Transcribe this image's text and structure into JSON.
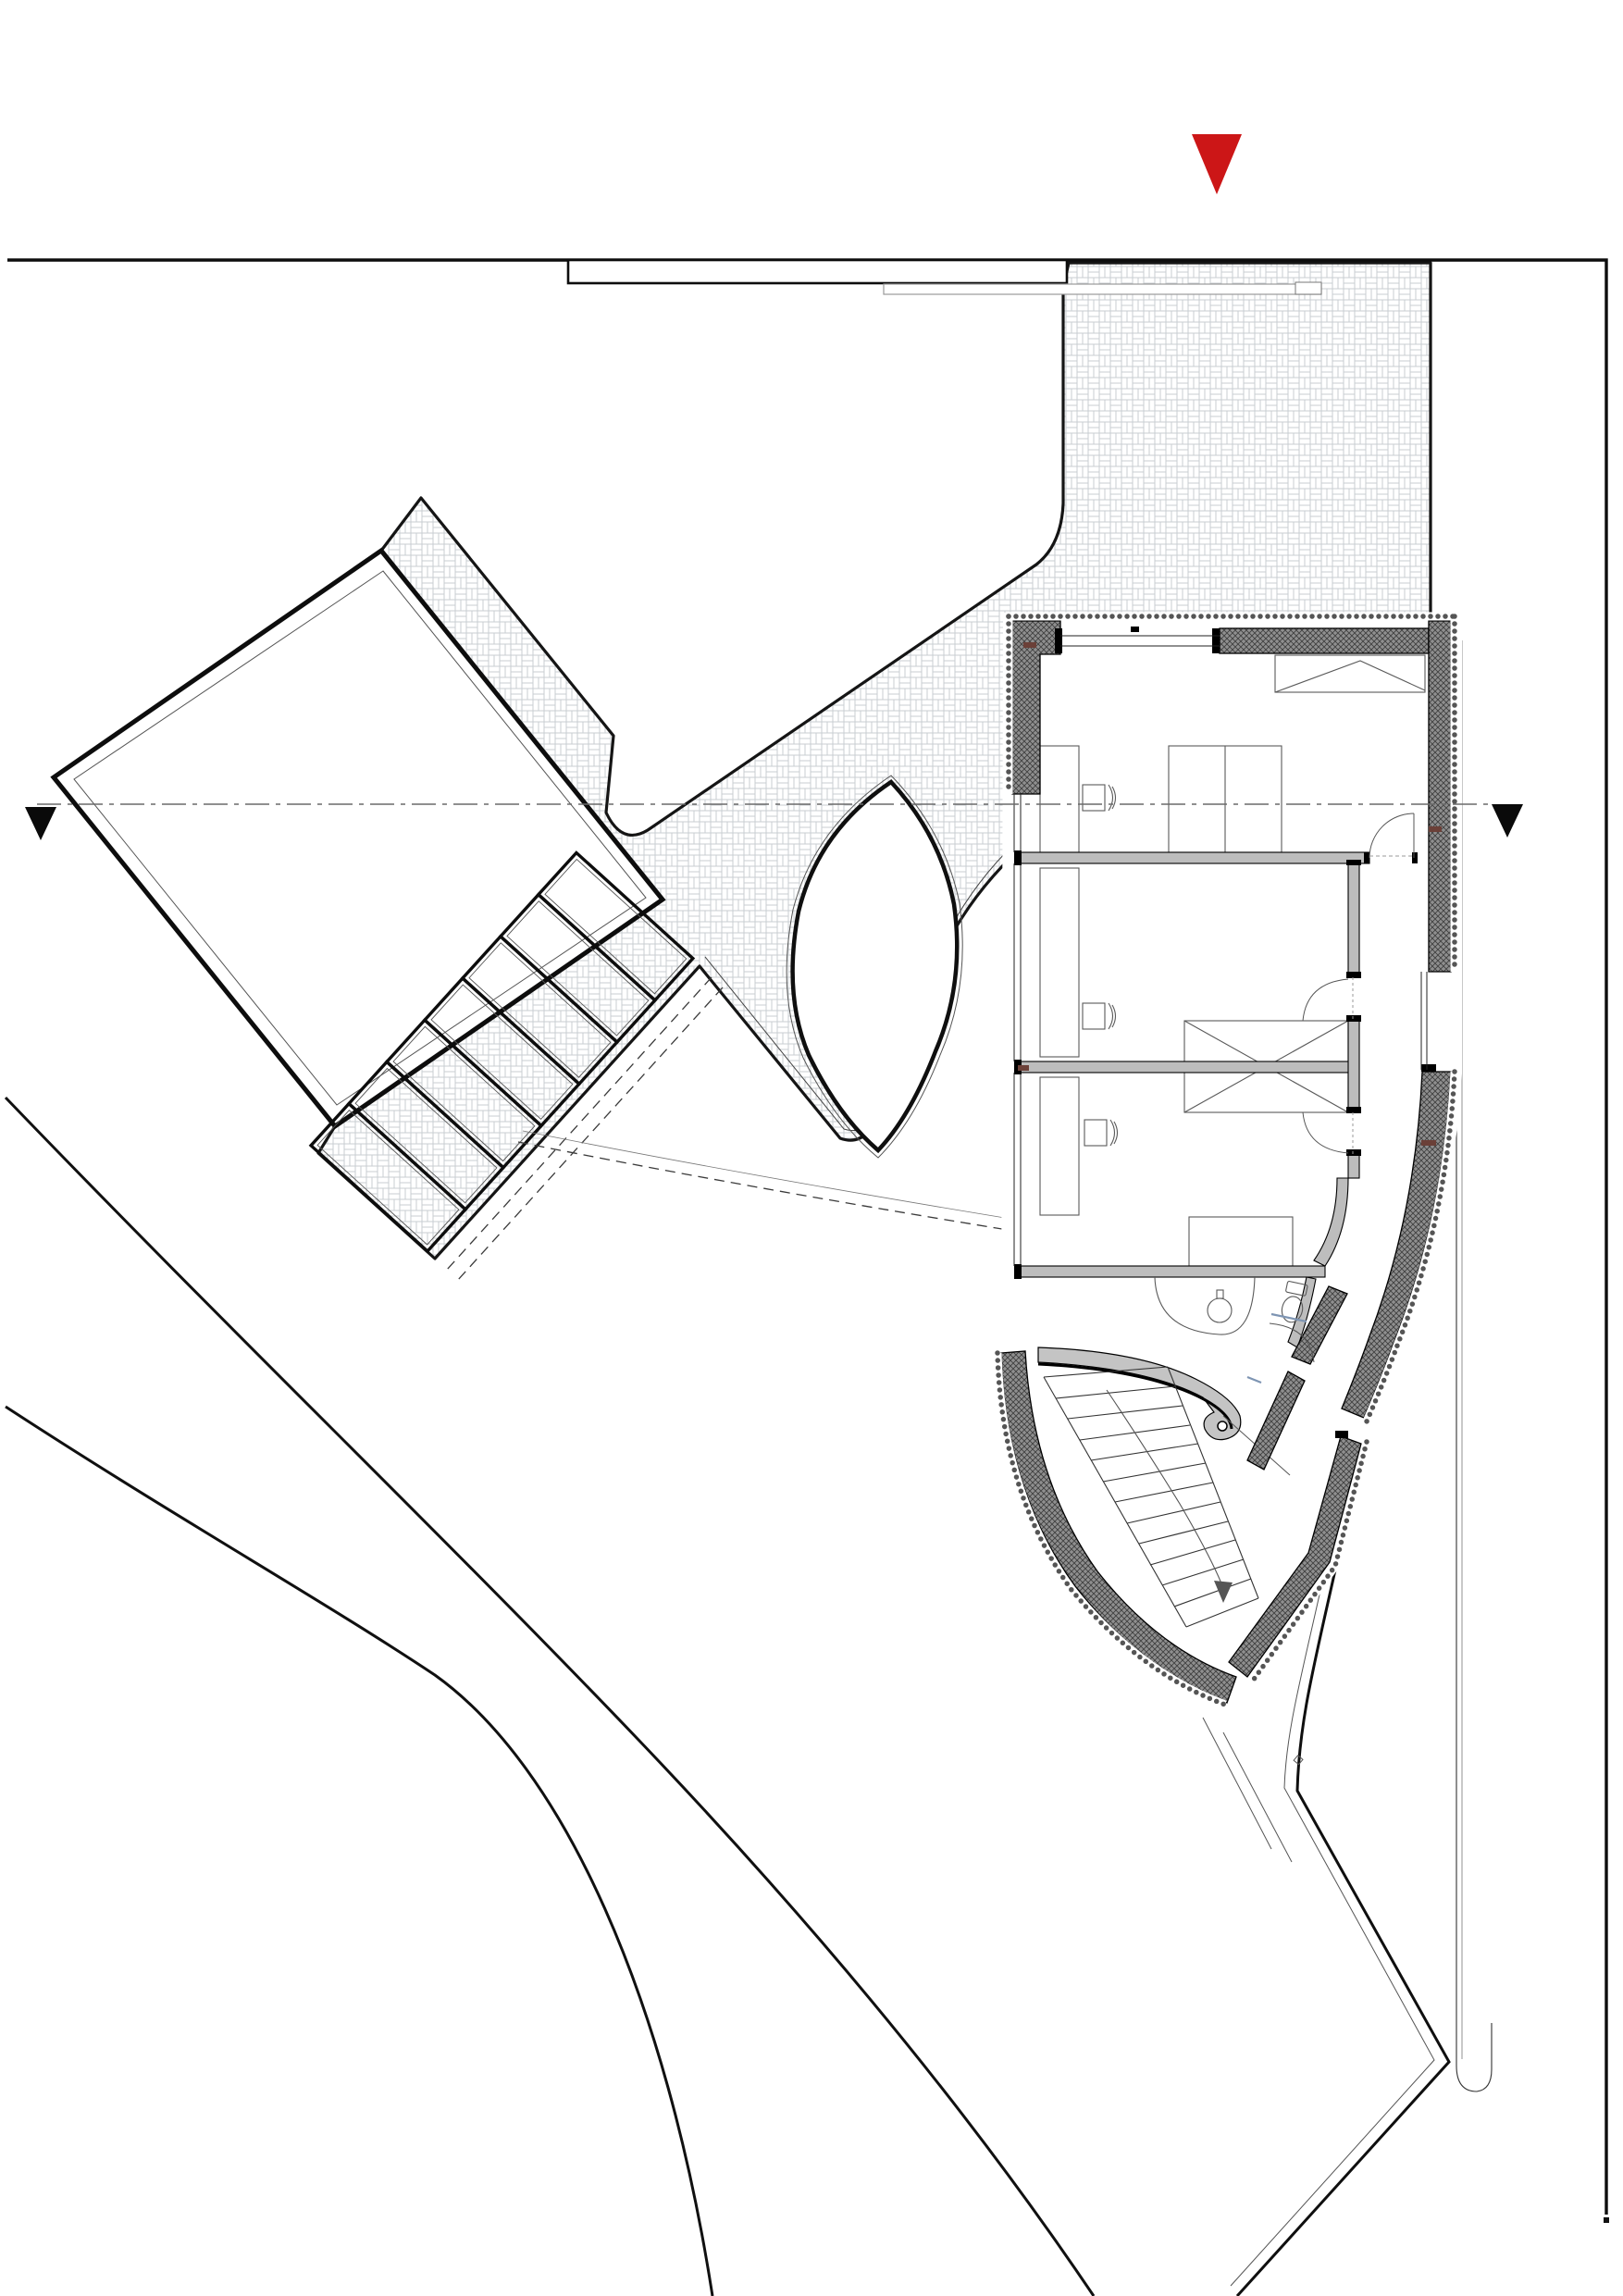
{
  "drawing": {
    "kind": "architectural site and floor plan",
    "visible_text": "none"
  },
  "colors": {
    "north_marker_red": "#cc1617",
    "section_marker_black": "#0a0a0a",
    "section_line_gray": "#6a6a6a",
    "boundary_black": "#111111",
    "paving_line_gray": "#c9ced2",
    "wall_gray": "#8f8f8f",
    "wall_hatch_line": "#3f3f3f",
    "partition_gray": "#bdbdbd",
    "wedge_gray": "#c4c4c4",
    "glass_blue": "#7e95b3",
    "timber_tick_brown": "#6b4038",
    "canopy_line_gray": "#9a9a9a"
  },
  "markers": {
    "north_triangle": "red-triangle-marker",
    "section_left": "black-triangle-marker",
    "section_right": "black-triangle-marker"
  },
  "site": {
    "parking_stalls": 7,
    "paved_area_pattern": "basket-weave",
    "street_edge_curves": 2,
    "neighbour_plot_rectangles": 1,
    "organic_island_shapes": 1
  },
  "building": {
    "rooms_visible": 3,
    "desks": 3,
    "chairs": 3,
    "beds": 2,
    "wardrobes": 2,
    "bathroom_fixtures": [
      "sink",
      "toilet",
      "shower"
    ],
    "stair_steps": 13,
    "door_arcs": 5
  }
}
